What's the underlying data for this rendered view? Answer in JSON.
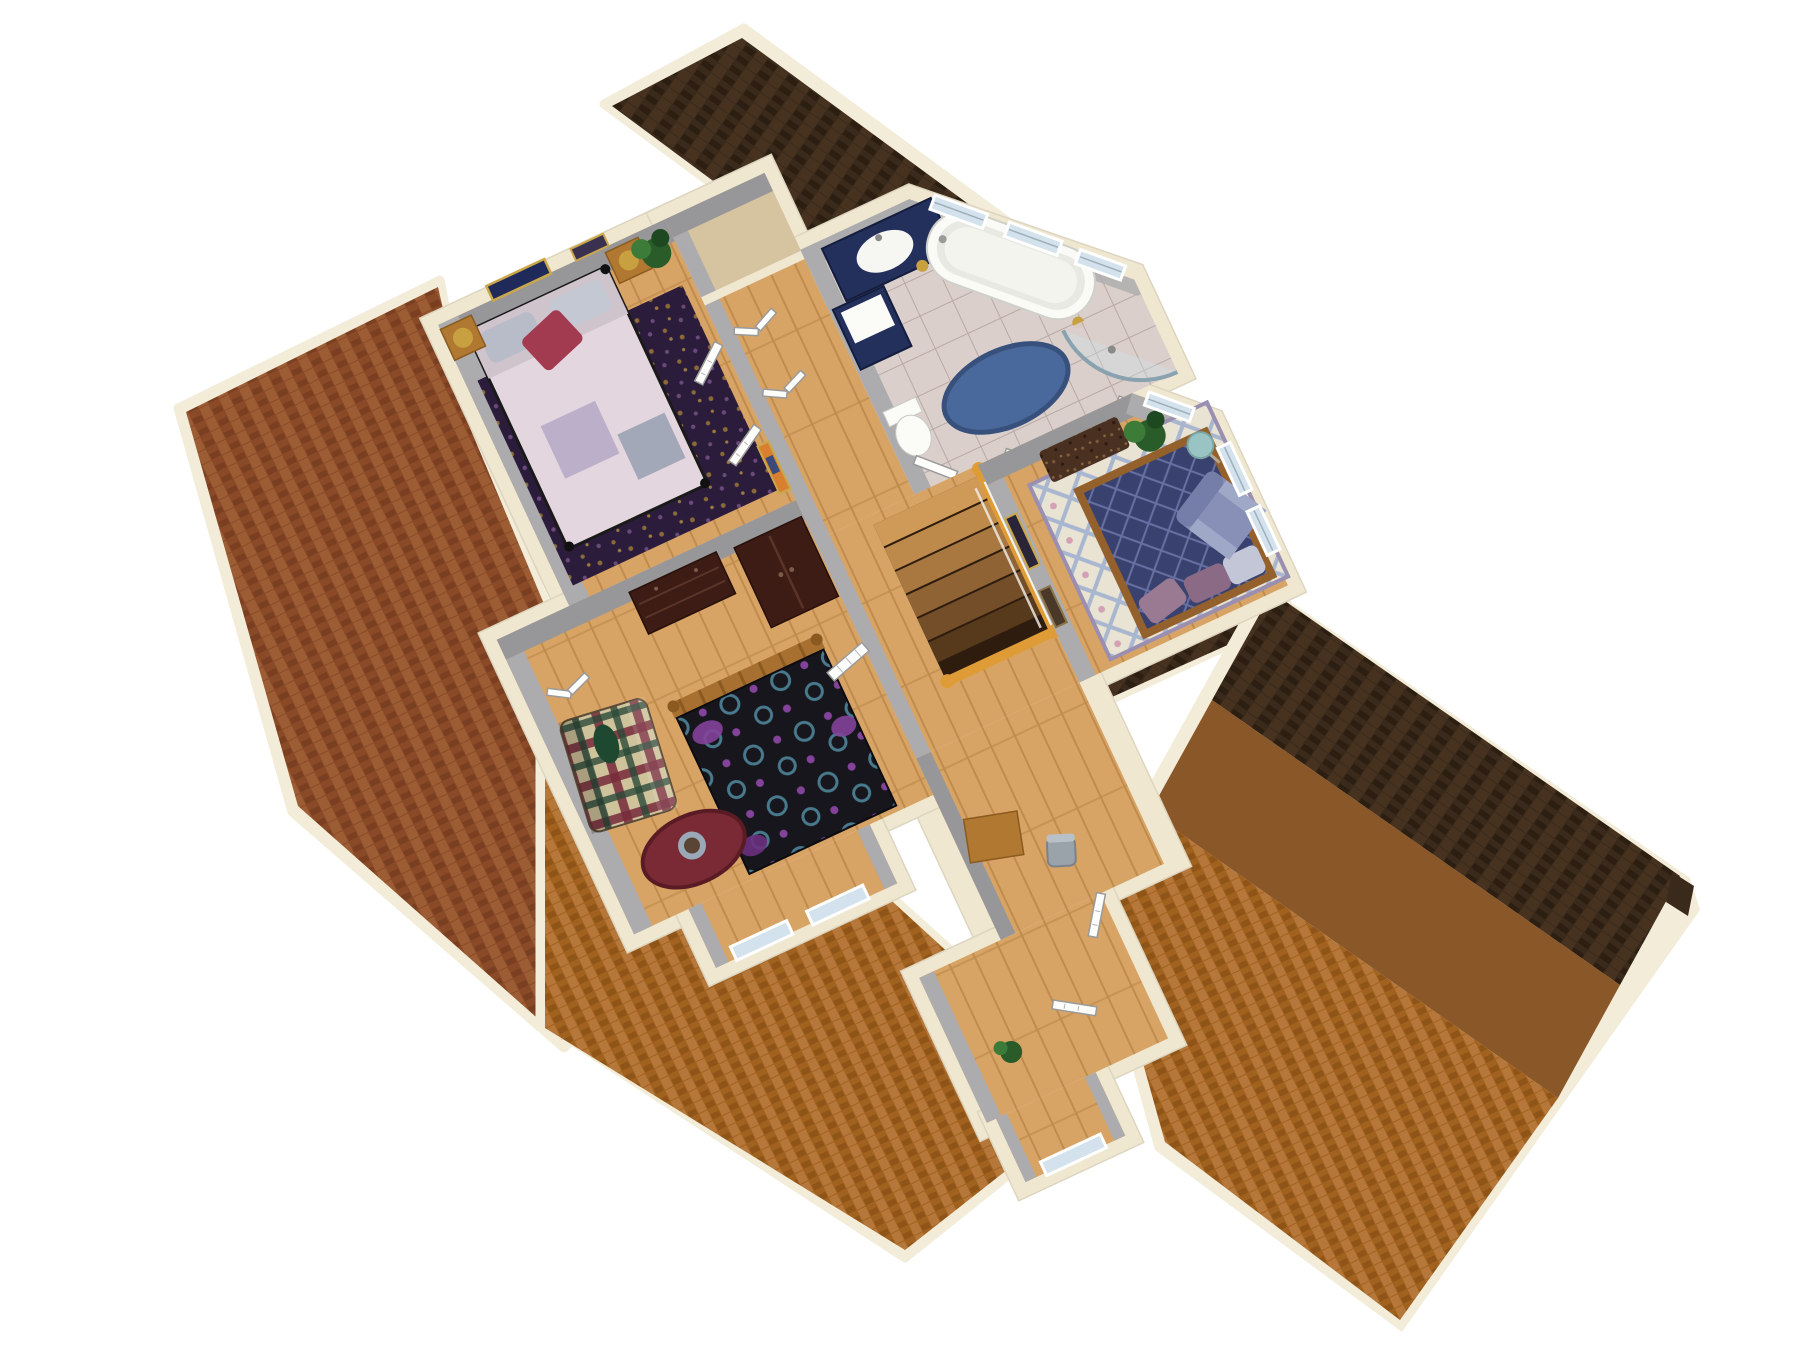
{
  "scene": {
    "label": "Isometric 3D cutaway rendering of a house second-floor plan with brown shingled roofs, wood floors, and furnished rooms",
    "view": "aerial isometric cutaway",
    "background": "#ffffff"
  },
  "palette": {
    "bg": "#ffffff",
    "roofDark": "#3a2a1b",
    "roofDarkLine": "#2c1e11",
    "roofRed": "#8a4a28",
    "roofRedCell": "#9c5c34",
    "roofOrange": "#a2621f",
    "roofOrangeCell": "#b5773a",
    "roofFlat": "#8a5728",
    "trimCream": "#f2ecd8",
    "wallCream": "#efe7d0",
    "wallGray": "#97979a",
    "wallGrayLt": "#acabad",
    "woodFloor": "#d8a465",
    "woodLine": "#c08c4e",
    "closetTan": "#d6c3a0",
    "tileFloor": "#dacfcb",
    "tileLine": "#b9a9a5",
    "navy": "#23305c",
    "tubWhite": "#fafaf6",
    "rugBlue": "#49699c",
    "rugPurple": "#2c1c3c",
    "rugTrellisBg": "#e9e3d3",
    "rugTrellisLine": "#a8b6d0",
    "quiltNavy": "#39426e",
    "quiltNavyLine": "#6670a2",
    "bedPink": "#e4d6de",
    "pillowRed": "#a23a50",
    "quiltDark": "#16161c",
    "quiltTeal": "#49798c",
    "quiltPurple": "#83439a",
    "plaidBg": "#cfc39c",
    "plaidRed": "#77293b",
    "plaidGreen": "#2c4a3a",
    "railOrange": "#df9c36",
    "doorWhite": "#fdfdfb",
    "glass": "#d3e2ec",
    "tableRed": "#7a2a34",
    "chairLavender": "#8890b8"
  },
  "rooms": [
    {
      "id": "bedroom-2",
      "name": "Bedroom 2 (upper-left)",
      "furniture": [
        "metal-frame bed with pink patch quilt and red pillow",
        "dark purple speckled area rug",
        "two nightstands with gold lamps",
        "potted plant",
        "framed wall art",
        "alcove with two console tables and dark vases",
        "fireplace chimney dormer"
      ]
    },
    {
      "id": "hallway",
      "name": "Central hallway and landing",
      "furniture": [
        "staircase opening with orange handrail and white balusters",
        "white paneled doors",
        "bifold closet doors",
        "framed art",
        "linen closet"
      ]
    },
    {
      "id": "bathroom",
      "name": "Bathroom (top, angled wing)",
      "furniture": [
        "navy vanity with white oval sink",
        "tall navy linen cabinet",
        "white clawfoot tub",
        "blue oval rug",
        "corner shower with curved glass",
        "toilet",
        "three awning windows"
      ]
    },
    {
      "id": "master-bedroom",
      "name": "Master bedroom (right)",
      "furniture": [
        "wood-frame bed with navy diamond quilt",
        "cream and blue trellis area rug",
        "dark speckled bench",
        "lavender armchair",
        "teal floor lamp",
        "potted plant",
        "bay corner windows",
        "double entry doors"
      ]
    },
    {
      "id": "bedroom-3",
      "name": "Bedroom 3 (lower-center)",
      "furniture": [
        "spindle bed with dark teal-swirl quilt",
        "chest of drawers",
        "armoire",
        "plaid loveseat",
        "oval dark-red table with bowl",
        "bifold closet doors",
        "dormer bay windows"
      ]
    },
    {
      "id": "lower-hall",
      "name": "Lower hallway (bottom wing)",
      "furniture": [
        "small wood desk with gray chair",
        "open white doors",
        "dormer window",
        "small plant"
      ]
    }
  ],
  "roofs": [
    {
      "id": "roof-top-dark",
      "name": "dark brown gable roof over angled bathroom wing"
    },
    {
      "id": "roof-left-red",
      "name": "red-brown shingle roof, left slope"
    },
    {
      "id": "roof-bottom-orange",
      "name": "orange-brown shingle roof, lower slope with dormers"
    },
    {
      "id": "roof-right-large",
      "name": "large right roof with dark ridge band, flat brown band, and orange shingle slope"
    }
  ]
}
